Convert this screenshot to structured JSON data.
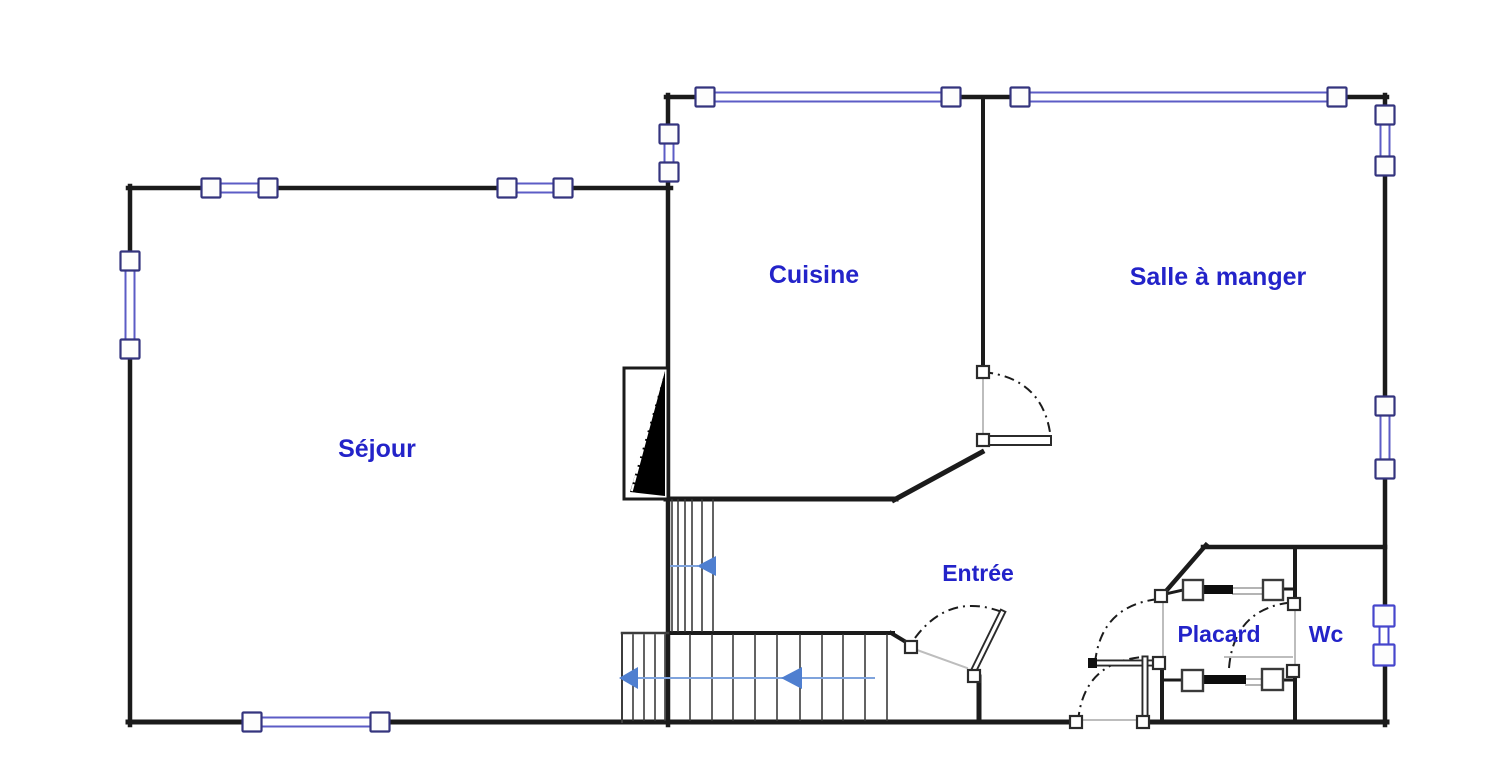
{
  "document": {
    "type": "floor-plan",
    "background": "#ffffff"
  },
  "colors": {
    "wall": "#1b1b1b",
    "window_frame": "#34347e",
    "window_glass": "#5c5cc6",
    "wc_window": "#4646cc",
    "label": "#2323c9",
    "arrow": "#4f7fd0",
    "arrow_line": "#7fa3dc",
    "gray": "#bdbdbd",
    "riser": "#3c3c3c",
    "leaf_edge": "#2b2b2b"
  },
  "rooms": [
    {
      "id": "sejour",
      "label": "Séjour",
      "x": 377,
      "y": 457,
      "size": 25
    },
    {
      "id": "cuisine",
      "label": "Cuisine",
      "x": 814,
      "y": 283,
      "size": 25
    },
    {
      "id": "salle-a-manger",
      "label": "Salle à manger",
      "x": 1218,
      "y": 285,
      "size": 25
    },
    {
      "id": "entree",
      "label": "Entrée",
      "x": 978,
      "y": 581,
      "size": 23
    },
    {
      "id": "placard",
      "label": "Placard",
      "x": 1219,
      "y": 642,
      "size": 23
    },
    {
      "id": "wc",
      "label": "Wc",
      "x": 1326,
      "y": 642,
      "size": 23
    }
  ],
  "geometry": {
    "walls": [
      [
        128,
        188,
        671,
        188,
        4.5
      ],
      [
        668,
        95,
        668,
        725,
        4.5
      ],
      [
        666,
        97,
        1387,
        97,
        4.5
      ],
      [
        1385,
        95,
        1385,
        725,
        4.5
      ],
      [
        130,
        186,
        130,
        725,
        4.5
      ],
      [
        128,
        722,
        1080,
        722,
        5
      ],
      [
        1139,
        722,
        1387,
        722,
        5
      ],
      [
        983,
        97,
        983,
        370,
        4
      ],
      [
        666,
        499,
        896,
        499,
        5
      ],
      [
        894,
        500,
        982,
        452,
        5
      ],
      [
        1203,
        547,
        1385,
        547,
        4.5
      ],
      [
        1206,
        545,
        1160,
        598,
        4.5
      ],
      [
        1295,
        547,
        1295,
        604,
        4
      ],
      [
        1295,
        666,
        1295,
        722,
        4
      ],
      [
        1162,
        660,
        1162,
        722,
        4
      ],
      [
        979,
        677,
        979,
        722,
        5
      ],
      [
        668,
        633,
        893,
        633,
        4
      ],
      [
        891,
        633,
        911,
        645,
        4
      ],
      [
        1161,
        595,
        1183,
        590,
        3
      ],
      [
        1283,
        589,
        1294,
        589,
        3
      ],
      [
        1162,
        680,
        1182,
        680,
        3
      ],
      [
        1283,
        680,
        1293,
        680,
        3
      ]
    ],
    "windows": [
      {
        "o": "h",
        "y": 188,
        "s1": 211,
        "s2": 268,
        "style": "std"
      },
      {
        "o": "h",
        "y": 188,
        "s1": 507,
        "s2": 563,
        "style": "std"
      },
      {
        "o": "h",
        "y": 97,
        "s1": 705,
        "s2": 951,
        "style": "std"
      },
      {
        "o": "h",
        "y": 97,
        "s1": 1020,
        "s2": 1337,
        "style": "std"
      },
      {
        "o": "h",
        "y": 722,
        "s1": 252,
        "s2": 380,
        "style": "std"
      },
      {
        "o": "v",
        "x": 130,
        "s1": 261,
        "s2": 349,
        "style": "std"
      },
      {
        "o": "v",
        "x": 669,
        "s1": 134,
        "s2": 172,
        "style": "std"
      },
      {
        "o": "v",
        "x": 1385,
        "s1": 115,
        "s2": 166,
        "style": "std"
      },
      {
        "o": "v",
        "x": 1385,
        "s1": 406,
        "s2": 469,
        "style": "std"
      },
      {
        "o": "v",
        "x": 1384,
        "s1": 616,
        "s2": 655,
        "style": "wc"
      }
    ],
    "posts": [
      [
        911,
        647
      ],
      [
        974,
        676
      ],
      [
        983,
        372
      ],
      [
        983,
        440
      ],
      [
        1076,
        722
      ],
      [
        1143,
        722
      ],
      [
        1161,
        596
      ],
      [
        1159,
        663
      ],
      [
        1294,
        604
      ],
      [
        1293,
        671
      ]
    ],
    "door_leaf_lines": [
      [
        973,
        672,
        1002,
        613
      ],
      [
        1092,
        663,
        1155,
        663
      ],
      [
        1145,
        659,
        1145,
        719
      ]
    ],
    "door_leaf_rects": [
      [
        985,
        436,
        66,
        9
      ]
    ],
    "door_leaf_caps": [
      [
        1088,
        658,
        9,
        10
      ]
    ],
    "swing_arcs": [
      [
        983,
        372,
        1045,
        378,
        1051,
        440
      ],
      [
        915,
        638,
        949,
        592,
        1002,
        612
      ],
      [
        1078,
        722,
        1083,
        662,
        1143,
        657
      ],
      [
        1095,
        663,
        1101,
        605,
        1159,
        599
      ],
      [
        1229,
        668,
        1234,
        607,
        1295,
        602
      ]
    ],
    "guide_lines": [
      [
        983,
        378,
        983,
        436
      ],
      [
        917,
        650,
        967,
        668
      ],
      [
        1295,
        606,
        1295,
        664
      ],
      [
        1084,
        720,
        1139,
        720
      ],
      [
        1225,
        657,
        1292,
        657
      ],
      [
        1163,
        601,
        1163,
        660
      ]
    ],
    "stairs": {
      "risers": [
        [
          672,
          500,
          631
        ],
        [
          678,
          500,
          631
        ],
        [
          685,
          500,
          631
        ],
        [
          692,
          500,
          631
        ],
        [
          702,
          500,
          631
        ],
        [
          713,
          500,
          631
        ],
        [
          690,
          635,
          720
        ],
        [
          712,
          635,
          720
        ],
        [
          733,
          635,
          720
        ],
        [
          755,
          635,
          720
        ],
        [
          777,
          635,
          720
        ],
        [
          800,
          635,
          720
        ],
        [
          822,
          635,
          720
        ],
        [
          843,
          635,
          720
        ],
        [
          865,
          635,
          720
        ],
        [
          887,
          635,
          720
        ],
        [
          633,
          635,
          720
        ],
        [
          644,
          635,
          720
        ],
        [
          655,
          635,
          720
        ],
        [
          665,
          635,
          720
        ]
      ],
      "edges": [
        [
          622,
          633,
          622,
          722,
          2
        ],
        [
          622,
          633,
          668,
          633,
          2.5
        ]
      ],
      "break_symbol": {
        "rect": [
          624,
          368,
          44,
          131
        ],
        "triangle": "665,371 665,496 630,492",
        "dash_line": [
          632,
          490,
          663,
          374
        ]
      }
    },
    "direction_arrows": {
      "heads": [
        [
          697,
          566,
          716,
          10
        ],
        [
          781,
          678,
          802,
          11
        ],
        [
          619,
          678,
          638,
          11
        ]
      ],
      "lines": [
        [
          671,
          566,
          697,
          566
        ],
        [
          638,
          678,
          783,
          678
        ],
        [
          800,
          678,
          874,
          678
        ]
      ]
    },
    "closet": {
      "boxes": [
        [
          1183,
          580,
          20,
          20
        ],
        [
          1263,
          580,
          20,
          20
        ],
        [
          1182,
          670,
          21,
          21
        ],
        [
          1262,
          669,
          21,
          21
        ]
      ],
      "bars": [
        [
          1202,
          585,
          31,
          9
        ],
        [
          1203,
          675,
          43,
          9
        ]
      ],
      "rails": [
        [
          1233,
          588,
          1262,
          588
        ],
        [
          1233,
          594,
          1262,
          594
        ],
        [
          1246,
          679,
          1262,
          679
        ],
        [
          1246,
          685,
          1262,
          685
        ]
      ]
    }
  }
}
